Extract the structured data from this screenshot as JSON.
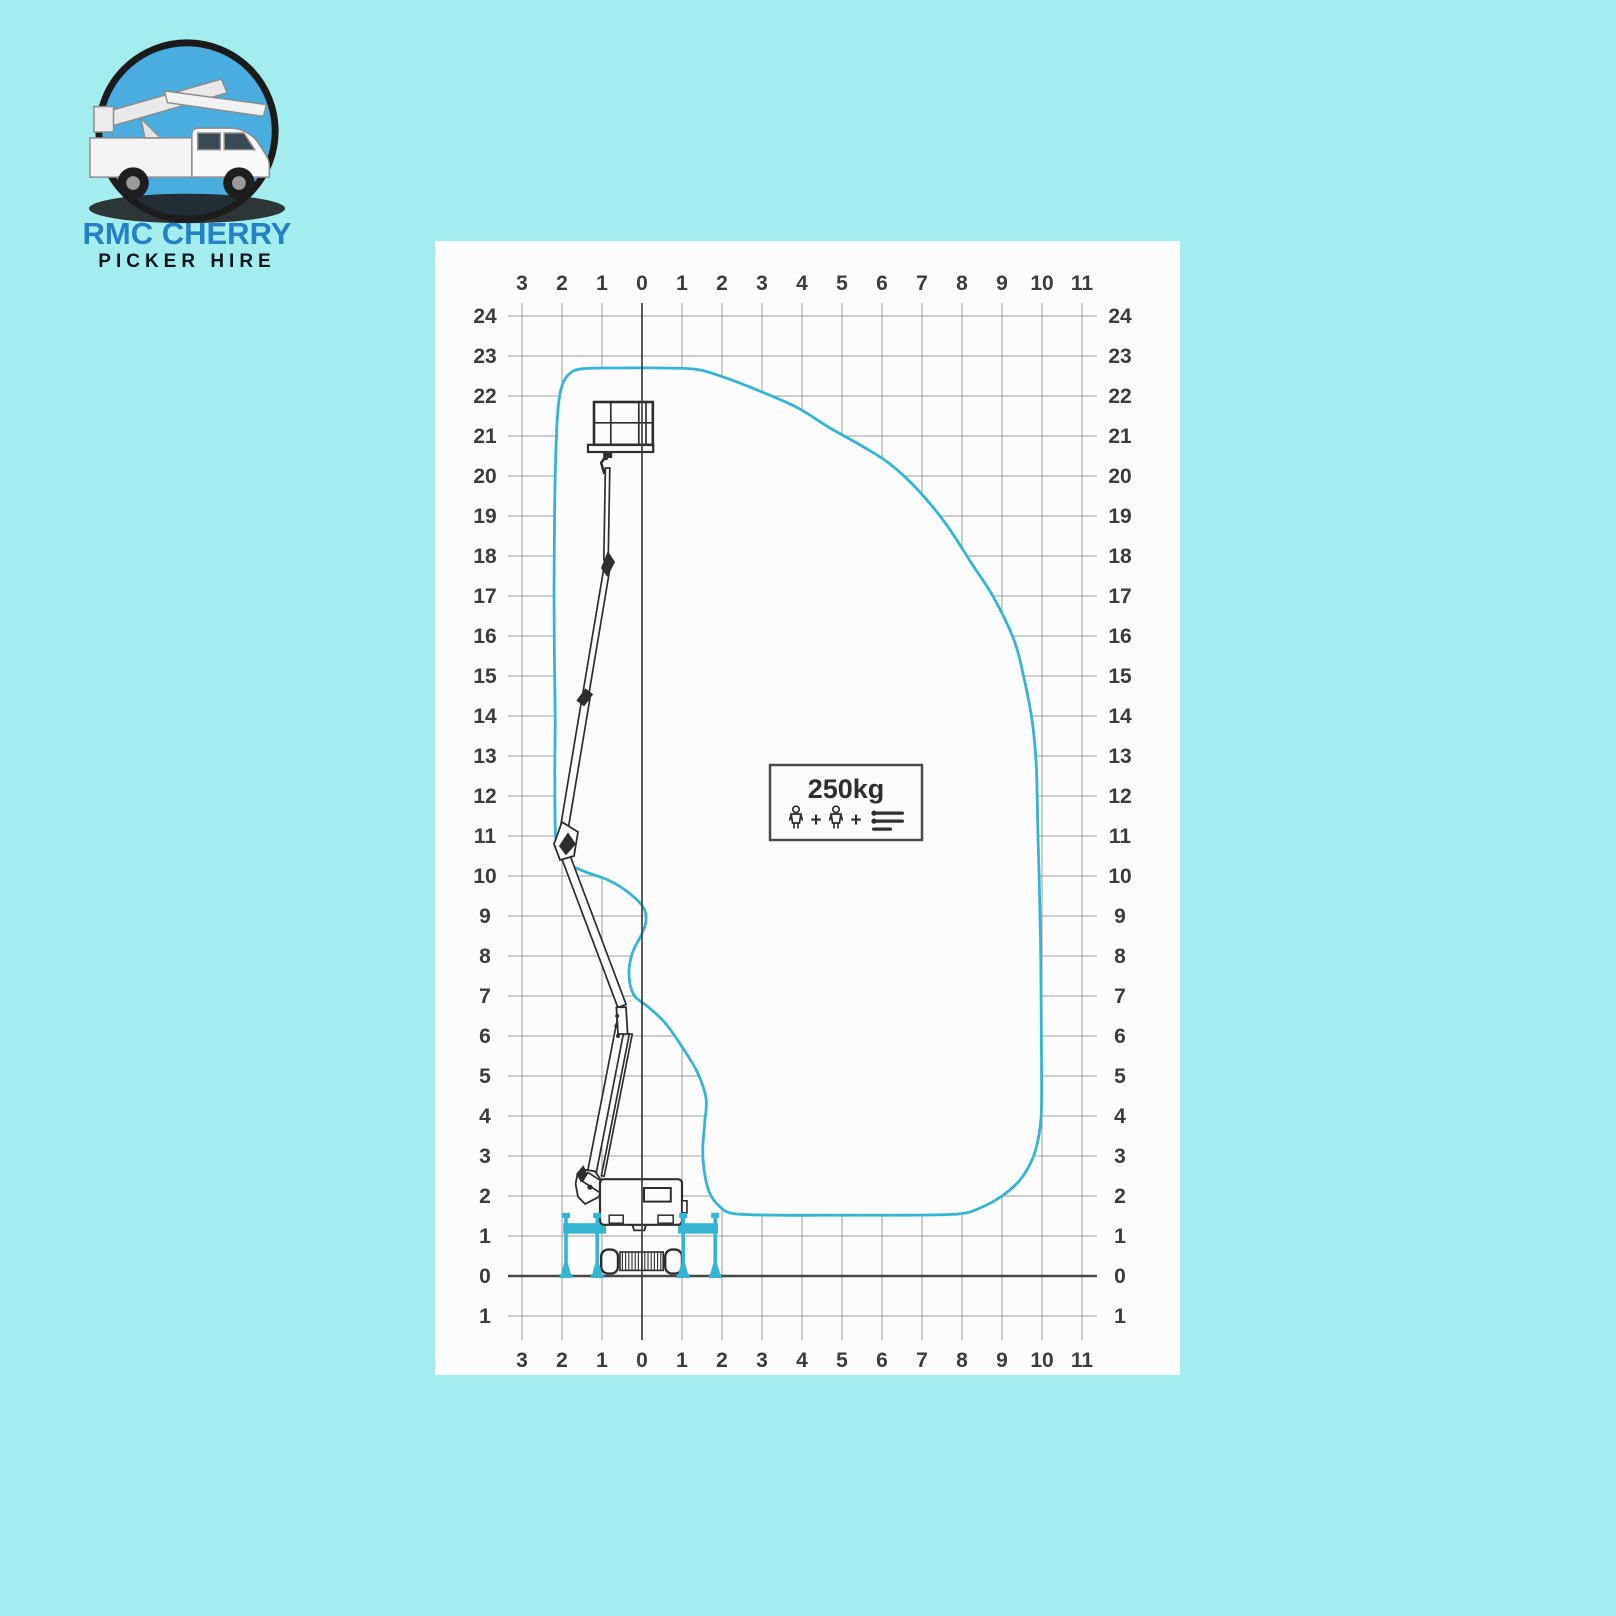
{
  "logo": {
    "title": "RMC CHERRY",
    "subtitle": "PICKER HIRE"
  },
  "colors": {
    "background": "#a4edef",
    "panel": "#fcfcfc",
    "envelope": "#34b6d2",
    "outrigger": "#34b6d2",
    "grid": "#9e9e9e",
    "axis": "#454545",
    "ink": "#2e2e2e",
    "label": "#3c3c3c",
    "logo_blue": "#2581c4",
    "logo_dark": "#10141f",
    "emblem_sky": "#49ade0"
  },
  "load_box": {
    "label": "250kg",
    "plus_sign": "+",
    "icons": [
      "person",
      "plus",
      "person",
      "plus",
      "tools"
    ]
  },
  "axes": {
    "x_values": [
      -3,
      -2,
      -1,
      0,
      1,
      2,
      3,
      4,
      5,
      6,
      7,
      8,
      9,
      10,
      11
    ],
    "x_labels": [
      "3",
      "2",
      "1",
      "0",
      "1",
      "2",
      "3",
      "4",
      "5",
      "6",
      "7",
      "8",
      "9",
      "10",
      "11"
    ],
    "y_values": [
      24,
      23,
      22,
      21,
      20,
      19,
      18,
      17,
      16,
      15,
      14,
      13,
      12,
      11,
      10,
      9,
      8,
      7,
      6,
      5,
      4,
      3,
      2,
      1,
      0,
      -1
    ],
    "y_labels": [
      "24",
      "23",
      "22",
      "21",
      "20",
      "19",
      "18",
      "17",
      "16",
      "15",
      "14",
      "13",
      "12",
      "11",
      "10",
      "9",
      "8",
      "7",
      "6",
      "5",
      "4",
      "3",
      "2",
      "1",
      "0",
      "1"
    ]
  },
  "chart_data": {
    "type": "area",
    "label": "250kg",
    "load_capacity_kg": 250,
    "x_ticks": [
      -3,
      -2,
      -1,
      0,
      1,
      2,
      3,
      4,
      5,
      6,
      7,
      8,
      9,
      10,
      11
    ],
    "y_ticks": [
      24,
      23,
      22,
      21,
      20,
      19,
      18,
      17,
      16,
      15,
      14,
      13,
      12,
      11,
      10,
      9,
      8,
      7,
      6,
      5,
      4,
      3,
      2,
      1,
      0,
      -1
    ],
    "xlim": [
      -3.5,
      11.5
    ],
    "ylim": [
      -1.5,
      24.6
    ],
    "grid": true,
    "max_height_m": 22.7,
    "max_outreach_m": 10,
    "envelope_points": [
      [
        -1.5,
        22.68
      ],
      [
        -0.5,
        22.7
      ],
      [
        0.5,
        22.7
      ],
      [
        1.4,
        22.66
      ],
      [
        2.1,
        22.45
      ],
      [
        3.0,
        22.1
      ],
      [
        3.9,
        21.7
      ],
      [
        4.7,
        21.2
      ],
      [
        5.5,
        20.75
      ],
      [
        6.2,
        20.3
      ],
      [
        6.9,
        19.65
      ],
      [
        7.6,
        18.8
      ],
      [
        8.25,
        17.8
      ],
      [
        8.8,
        16.95
      ],
      [
        9.3,
        15.9
      ],
      [
        9.55,
        14.95
      ],
      [
        9.75,
        13.9
      ],
      [
        9.85,
        12.9
      ],
      [
        9.88,
        11.95
      ],
      [
        9.9,
        10.95
      ],
      [
        9.93,
        9.95
      ],
      [
        9.95,
        8.95
      ],
      [
        9.97,
        7.95
      ],
      [
        9.98,
        6.5
      ],
      [
        9.99,
        5.0
      ],
      [
        9.98,
        4.0
      ],
      [
        9.9,
        3.4
      ],
      [
        9.75,
        2.9
      ],
      [
        9.45,
        2.4
      ],
      [
        9.0,
        2.0
      ],
      [
        8.45,
        1.7
      ],
      [
        7.9,
        1.55
      ],
      [
        6.5,
        1.52
      ],
      [
        5.0,
        1.52
      ],
      [
        3.5,
        1.52
      ],
      [
        2.3,
        1.56
      ],
      [
        1.92,
        1.76
      ],
      [
        1.68,
        2.1
      ],
      [
        1.56,
        2.6
      ],
      [
        1.52,
        3.2
      ],
      [
        1.57,
        3.85
      ],
      [
        1.6,
        4.45
      ],
      [
        1.38,
        5.1
      ],
      [
        1.02,
        5.7
      ],
      [
        0.6,
        6.3
      ],
      [
        0.15,
        6.73
      ],
      [
        -0.17,
        6.98
      ],
      [
        -0.3,
        7.3
      ],
      [
        -0.32,
        7.7
      ],
      [
        -0.22,
        8.13
      ],
      [
        -0.02,
        8.52
      ],
      [
        0.1,
        8.87
      ],
      [
        0.03,
        9.22
      ],
      [
        -0.38,
        9.62
      ],
      [
        -0.85,
        9.9
      ],
      [
        -1.35,
        10.08
      ],
      [
        -1.8,
        10.28
      ],
      [
        -2.06,
        10.58
      ],
      [
        -2.16,
        11.0
      ],
      [
        -2.18,
        12.5
      ],
      [
        -2.17,
        14.0
      ],
      [
        -2.19,
        15.5
      ],
      [
        -2.2,
        17.0
      ],
      [
        -2.19,
        18.5
      ],
      [
        -2.17,
        20.0
      ],
      [
        -2.12,
        21.4
      ],
      [
        -2.03,
        22.15
      ],
      [
        -1.85,
        22.52
      ]
    ]
  }
}
